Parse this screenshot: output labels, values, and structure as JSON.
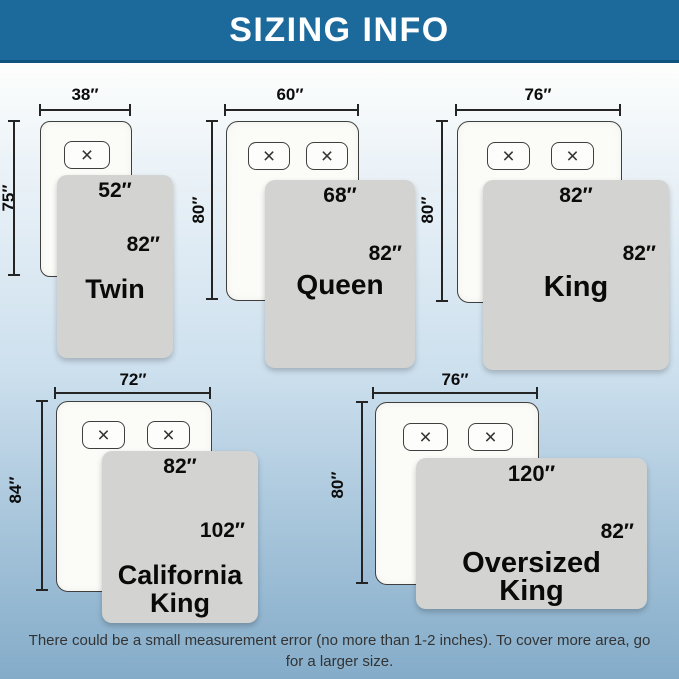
{
  "header": {
    "title": "SIZING INFO"
  },
  "colors": {
    "banner_bg": "#1c699c",
    "banner_text": "#ffffff",
    "background_top": "#fdfefc",
    "background_bottom": "#84acc9",
    "mattress_fill": "#fbfbf8",
    "blanket_fill": "#d3d3d1",
    "label_text": "#0b0b0b"
  },
  "icons": {
    "pillow_x": "×"
  },
  "beds": [
    {
      "name": "Twin",
      "name_lines": [
        "Twin"
      ],
      "mattress_width": "38″",
      "mattress_length": "75″",
      "blanket_width": "52″",
      "blanket_length": "82″",
      "pillows": 1
    },
    {
      "name": "Queen",
      "name_lines": [
        "Queen"
      ],
      "mattress_width": "60″",
      "mattress_length": "80″",
      "blanket_width": "68″",
      "blanket_length": "82″",
      "pillows": 2
    },
    {
      "name": "King",
      "name_lines": [
        "King"
      ],
      "mattress_width": "76″",
      "mattress_length": "80″",
      "blanket_width": "82″",
      "blanket_length": "82″",
      "pillows": 2
    },
    {
      "name": "California King",
      "name_lines": [
        "California",
        "King"
      ],
      "mattress_width": "72″",
      "mattress_length": "84″",
      "blanket_width": "82″",
      "blanket_length": "102″",
      "pillows": 2
    },
    {
      "name": "Oversized King",
      "name_lines": [
        "Oversized",
        "King"
      ],
      "mattress_width": "76″",
      "mattress_length": "80″",
      "blanket_width": "120″",
      "blanket_length": "82″",
      "pillows": 2
    }
  ],
  "footer": {
    "note": "There could be a small measurement error (no more than 1-2 inches). To cover more area, go for a larger size."
  }
}
